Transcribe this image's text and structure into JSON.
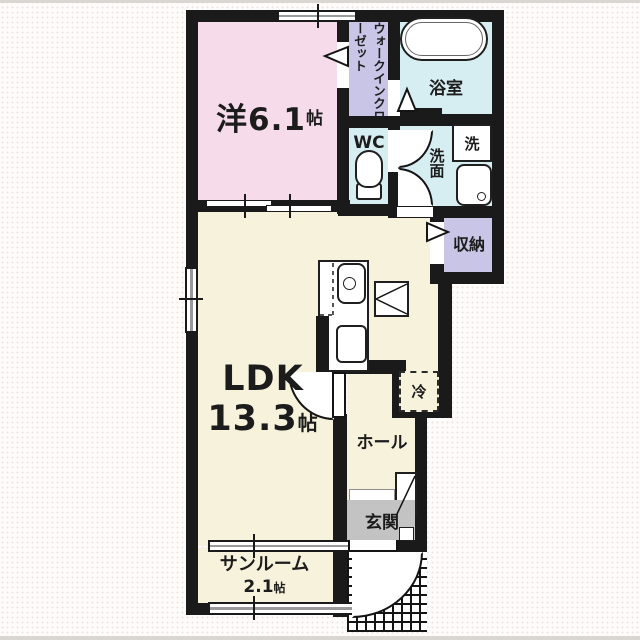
{
  "title": "apartment-floor-plan",
  "colors": {
    "wall": "#1a1a1a",
    "western": "#f6dcea",
    "closet": "#c9c5e6",
    "wet": "#d6eef2",
    "living": "#f7f2dc",
    "genkan": "#c3c3c3",
    "background": "#fdfcfb"
  },
  "rooms": {
    "western": {
      "label": "洋6.1",
      "unit": "帖"
    },
    "wic": {
      "label": "ウォークインクローゼット"
    },
    "bath": {
      "label": "浴室"
    },
    "wc": {
      "label": "WC"
    },
    "washer": {
      "label": "洗"
    },
    "lavatory": {
      "label": "洗面"
    },
    "storage": {
      "label": "収納"
    },
    "ldk": {
      "label": "LDK",
      "size": "13.3",
      "unit": "帖"
    },
    "fridge": {
      "label": "冷"
    },
    "hall": {
      "label": "ホール"
    },
    "entrance": {
      "label": "玄関"
    },
    "sunroom": {
      "label": "サンルーム",
      "size": "2.1",
      "unit": "帖"
    }
  }
}
